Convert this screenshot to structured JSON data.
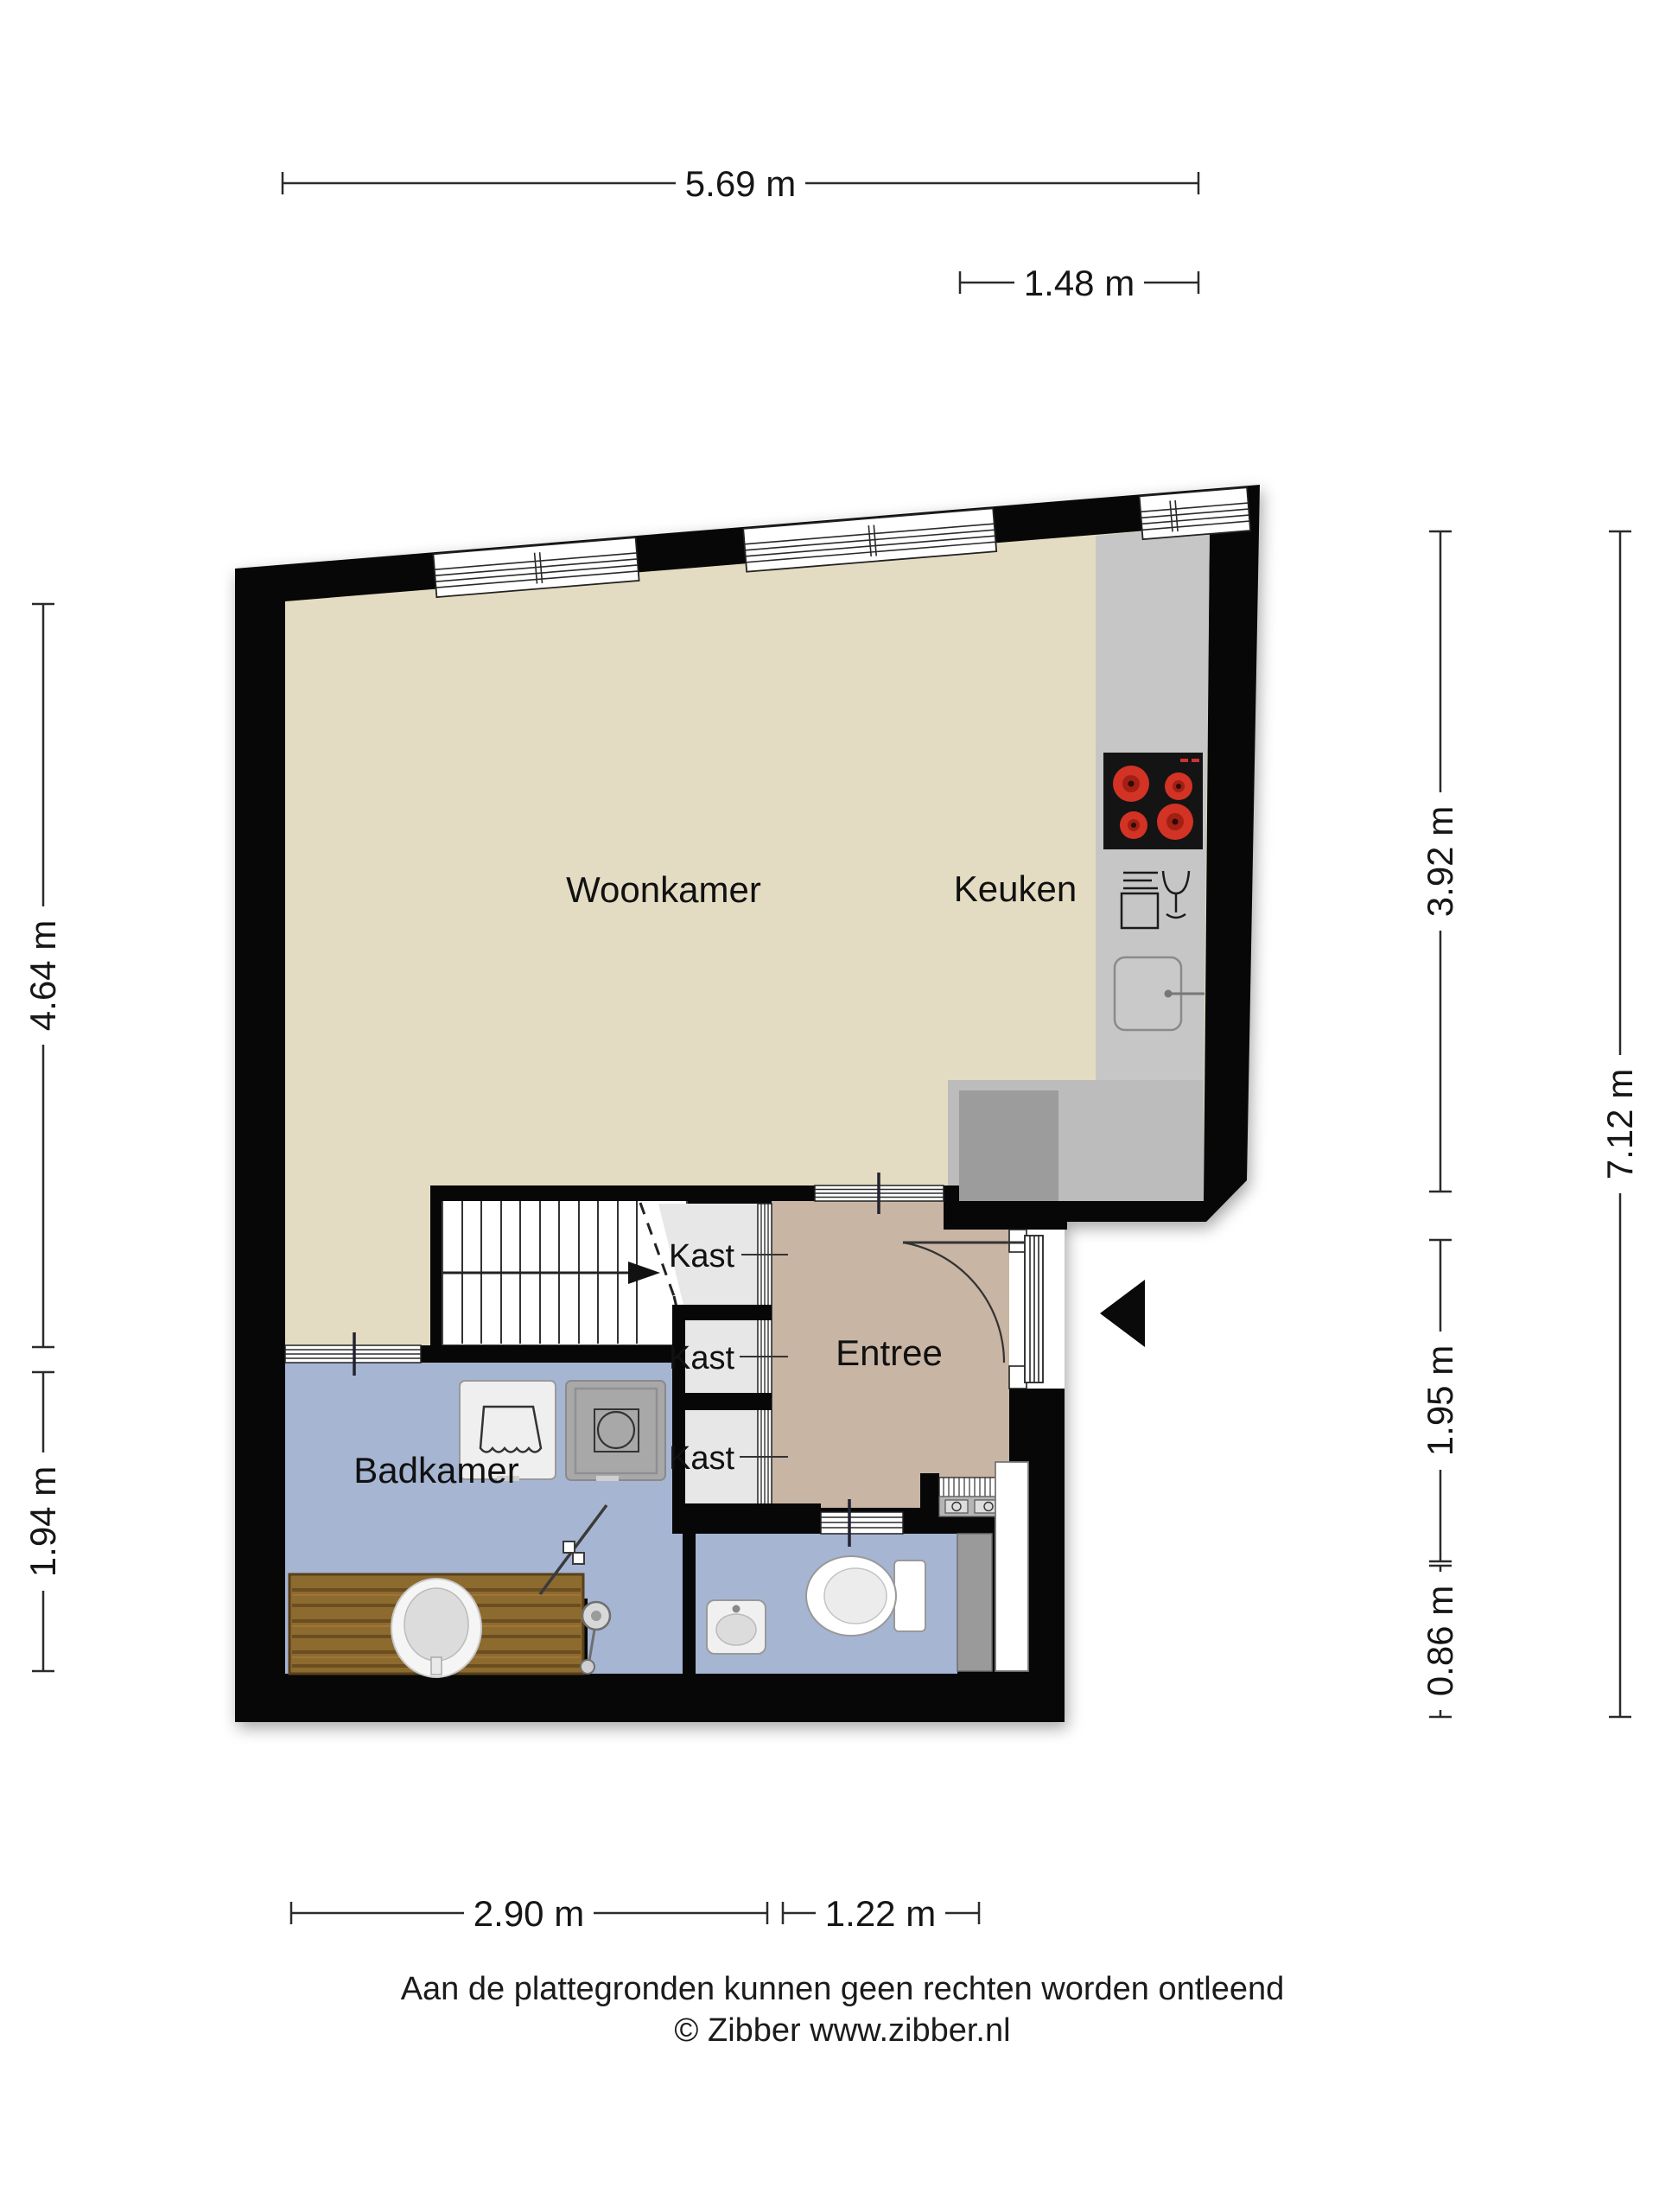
{
  "plan": {
    "rooms": {
      "woonkamer": "Woonkamer",
      "keuken": "Keuken",
      "badkamer": "Badkamer",
      "entree": "Entree",
      "kasts": [
        "Kast",
        "Kast",
        "Kast"
      ]
    },
    "dimensions": {
      "top_width": "5.69 m",
      "top_right_width": "1.48 m",
      "left_upper": "4.64 m",
      "left_lower": "1.94 m",
      "right_upper": "3.92 m",
      "right_mid": "1.95 m",
      "right_lower": "0.86 m",
      "right_total": "7.12 m",
      "bottom_left": "2.90 m",
      "bottom_right": "1.22 m"
    },
    "icons": [
      "window-icon",
      "cooktop-icon",
      "dishwasher-icon",
      "kitchen-sink-icon",
      "stairs-icon",
      "stairs-direction-arrow-icon",
      "kast-doors-icon",
      "door-swing-icon",
      "front-door-icon",
      "entrance-arrow-icon",
      "washing-machine-icon",
      "dryer-icon",
      "vanity-icon",
      "vanity-sink-icon",
      "shower-door-icon",
      "shower-head-icon",
      "toilet-icon",
      "hand-basin-icon",
      "radiator-icon",
      "meter-cabinet-icon",
      "shaft-icon"
    ],
    "colors": {
      "wall": "#070707",
      "woonkamer": "#e3dcc2",
      "entree": "#c8b5a4",
      "bathroom": "#a6b5d2",
      "toilet": "#a6b5d2",
      "kast": "#e7e7e7",
      "counter": "#c6c6c6",
      "kitchen_floor": "#bcbcbc",
      "kitchen_block": "#9c9c9c",
      "stairs": "#ffffff",
      "wood": "#8d6a2e",
      "burner": "#d23324"
    }
  },
  "footer": {
    "disclaimer": "Aan de plattegronden kunnen geen rechten worden ontleend",
    "copyright": "© Zibber www.zibber.nl"
  }
}
